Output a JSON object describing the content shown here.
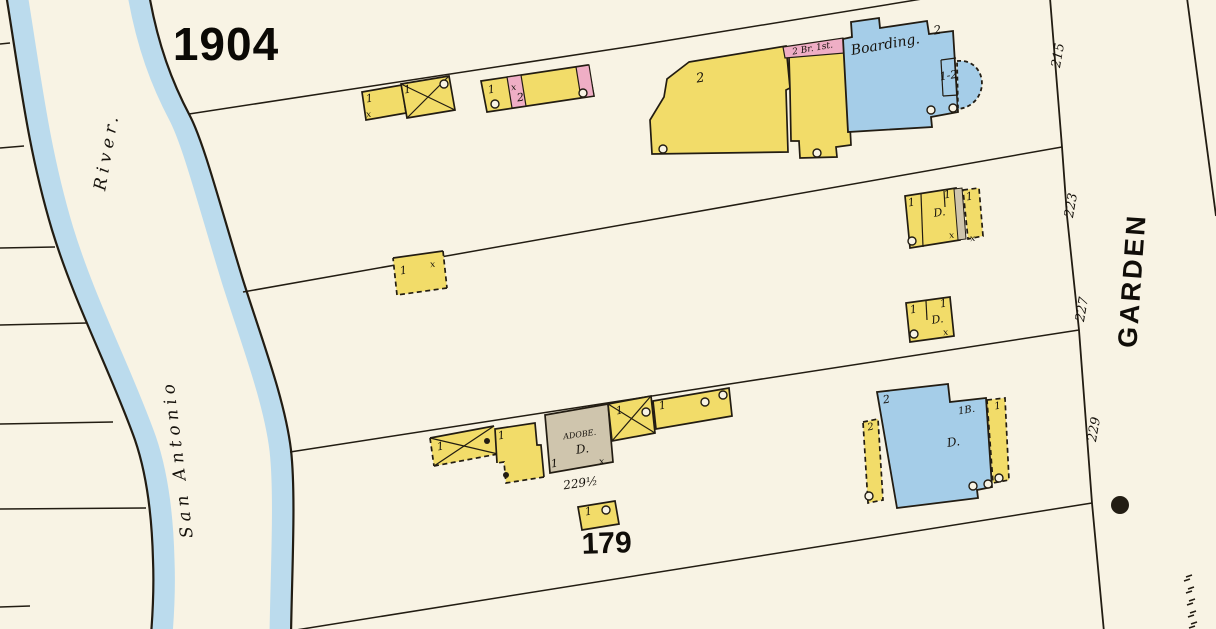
{
  "map": {
    "year": "1904",
    "block_number": "179",
    "street": {
      "name": "GARDEN",
      "house_numbers": [
        "215",
        "223",
        "227",
        "229"
      ]
    },
    "river": {
      "name": "San Antonio River."
    },
    "building_notes": [
      "Boarding.",
      "2 Br. 1st.",
      "ADOBE.",
      "D.",
      "229½",
      "1B.",
      "1-2"
    ],
    "colors": {
      "paper": "#f8f3e4",
      "ink": "#221c12",
      "water": "#b7d9ed",
      "yellow": "#f2dc69",
      "pink": "#efaec5",
      "blue": "#a5cde8",
      "adobe": "#cfc5ad"
    },
    "annotations": [
      {
        "id": "year",
        "t": "1904",
        "x": 226,
        "y": 60,
        "s": 46,
        "r": 0,
        "c": "t-year"
      },
      {
        "id": "river-name-river",
        "t": "River.",
        "x": 112,
        "y": 152,
        "s": 17,
        "r": -80,
        "c": "t-hand",
        "ls": 5
      },
      {
        "id": "river-name-san-antonio",
        "t": "San Antonio",
        "x": 183,
        "y": 458,
        "s": 17,
        "r": -97,
        "c": "t-hand",
        "ls": 5
      },
      {
        "id": "street-name-garden",
        "t": "GARDEN",
        "x": 1141,
        "y": 281,
        "s": 27,
        "r": -86,
        "c": "t-street",
        "ls": 3
      },
      {
        "id": "house-number-215",
        "t": "215",
        "x": 1062,
        "y": 56,
        "s": 13,
        "r": -80,
        "c": "t-hand"
      },
      {
        "id": "house-number-223",
        "t": "223",
        "x": 1075,
        "y": 206,
        "s": 13,
        "r": -80,
        "c": "t-hand"
      },
      {
        "id": "house-number-227",
        "t": "227",
        "x": 1086,
        "y": 310,
        "s": 13,
        "r": -80,
        "c": "t-hand"
      },
      {
        "id": "house-number-229",
        "t": "229",
        "x": 1098,
        "y": 430,
        "s": 13,
        "r": -80,
        "c": "t-hand"
      },
      {
        "id": "block-number",
        "t": "179",
        "x": 607,
        "y": 553,
        "s": 30,
        "r": -2,
        "c": "t-block"
      },
      {
        "id": "boarding-label",
        "t": "Boarding.",
        "x": 886,
        "y": 49,
        "s": 14,
        "r": -10,
        "c": "t-hand"
      },
      {
        "id": "brick-note",
        "t": "2 Br. 1st.",
        "x": 813,
        "y": 51,
        "s": 9,
        "r": -10,
        "c": "t-hand"
      },
      {
        "id": "complex-stories",
        "t": "2",
        "x": 701,
        "y": 82,
        "s": 13,
        "r": -9,
        "c": "t-hand"
      },
      {
        "id": "boarding-stories",
        "t": "2",
        "x": 938,
        "y": 34,
        "s": 12,
        "r": -9,
        "c": "t-hand"
      },
      {
        "id": "boarding-bay-stories",
        "t": "1-2",
        "x": 949,
        "y": 79,
        "s": 11,
        "r": -9,
        "c": "t-hand"
      },
      {
        "id": "b1-stories-a",
        "t": "1",
        "x": 370,
        "y": 102,
        "s": 11,
        "r": -9,
        "c": "t-hand"
      },
      {
        "id": "b1-stories-b",
        "t": "1",
        "x": 408,
        "y": 93,
        "s": 11,
        "r": -9,
        "c": "t-hand"
      },
      {
        "id": "b1-x",
        "t": "x",
        "x": 369,
        "y": 117,
        "s": 9,
        "r": -9,
        "c": "t-hand"
      },
      {
        "id": "b2-stories-a",
        "t": "1",
        "x": 492,
        "y": 93,
        "s": 11,
        "r": -9,
        "c": "t-hand"
      },
      {
        "id": "b2-stories-b",
        "t": "2",
        "x": 521,
        "y": 101,
        "s": 11,
        "r": -9,
        "c": "t-hand"
      },
      {
        "id": "b2-x",
        "t": "x",
        "x": 514,
        "y": 90,
        "s": 9,
        "r": -9,
        "c": "t-hand"
      },
      {
        "id": "b4-stories-a",
        "t": "1",
        "x": 912,
        "y": 206,
        "s": 11,
        "r": -9,
        "c": "t-hand"
      },
      {
        "id": "b4-stories-b",
        "t": "1",
        "x": 948,
        "y": 198,
        "s": 11,
        "r": -9,
        "c": "t-hand"
      },
      {
        "id": "b4-stories-c",
        "t": "1",
        "x": 970,
        "y": 200,
        "s": 11,
        "r": -9,
        "c": "t-hand"
      },
      {
        "id": "b4-dwelling",
        "t": "D.",
        "x": 940,
        "y": 216,
        "s": 11,
        "r": -9,
        "c": "t-hand"
      },
      {
        "id": "b4-x-a",
        "t": "x",
        "x": 952,
        "y": 238,
        "s": 9,
        "r": -9,
        "c": "t-hand"
      },
      {
        "id": "b4-x-b",
        "t": "x",
        "x": 973,
        "y": 241,
        "s": 9,
        "r": -9,
        "c": "t-hand"
      },
      {
        "id": "b5-stories-a",
        "t": "1",
        "x": 914,
        "y": 313,
        "s": 11,
        "r": -9,
        "c": "t-hand"
      },
      {
        "id": "b5-stories-b",
        "t": "1",
        "x": 944,
        "y": 307,
        "s": 11,
        "r": -9,
        "c": "t-hand"
      },
      {
        "id": "b5-dwelling",
        "t": "D.",
        "x": 938,
        "y": 323,
        "s": 11,
        "r": -9,
        "c": "t-hand"
      },
      {
        "id": "b5-x",
        "t": "x",
        "x": 946,
        "y": 335,
        "s": 9,
        "r": -9,
        "c": "t-hand"
      },
      {
        "id": "b6-stories",
        "t": "1",
        "x": 404,
        "y": 274,
        "s": 11,
        "r": -9,
        "c": "t-hand"
      },
      {
        "id": "b6-x",
        "t": "x",
        "x": 433,
        "y": 267,
        "s": 9,
        "r": -9,
        "c": "t-hand"
      },
      {
        "id": "b7-porch-stories",
        "t": "1",
        "x": 441,
        "y": 450,
        "s": 11,
        "r": -9,
        "c": "t-hand"
      },
      {
        "id": "b7-center-stories",
        "t": "1",
        "x": 502,
        "y": 439,
        "s": 11,
        "r": -9,
        "c": "t-hand"
      },
      {
        "id": "adobe-label",
        "t": "ADOBE.",
        "x": 580,
        "y": 437,
        "s": 8,
        "r": -8,
        "c": "t-hand"
      },
      {
        "id": "adobe-dwelling",
        "t": "D.",
        "x": 583,
        "y": 453,
        "s": 12,
        "r": -8,
        "c": "t-hand"
      },
      {
        "id": "adobe-stories",
        "t": "1",
        "x": 555,
        "y": 467,
        "s": 11,
        "r": -8,
        "c": "t-hand"
      },
      {
        "id": "adobe-x",
        "t": "x",
        "x": 602,
        "y": 464,
        "s": 9,
        "r": -8,
        "c": "t-hand"
      },
      {
        "id": "adobe-address",
        "t": "229½",
        "x": 581,
        "y": 487,
        "s": 12,
        "r": -8,
        "c": "t-hand"
      },
      {
        "id": "b7-xbldg-stories",
        "t": "1",
        "x": 620,
        "y": 414,
        "s": 11,
        "r": -9,
        "c": "t-hand"
      },
      {
        "id": "b7-bar-stories",
        "t": "1",
        "x": 663,
        "y": 409,
        "s": 11,
        "r": -9,
        "c": "t-hand"
      },
      {
        "id": "b8-stories",
        "t": "1",
        "x": 589,
        "y": 515,
        "s": 11,
        "r": -9,
        "c": "t-hand"
      },
      {
        "id": "b9-stories",
        "t": "2",
        "x": 887,
        "y": 403,
        "s": 11,
        "r": -9,
        "c": "t-hand"
      },
      {
        "id": "b9-basement",
        "t": "1B.",
        "x": 967,
        "y": 413,
        "s": 10,
        "r": -9,
        "c": "t-hand"
      },
      {
        "id": "b9-dwelling",
        "t": "D.",
        "x": 954,
        "y": 446,
        "s": 12,
        "r": -9,
        "c": "t-hand"
      },
      {
        "id": "b9-porch-left-stories",
        "t": "2",
        "x": 871,
        "y": 430,
        "s": 10,
        "r": -9,
        "c": "t-hand"
      },
      {
        "id": "b9-porch-right-stories",
        "t": "1",
        "x": 998,
        "y": 409,
        "s": 10,
        "r": -9,
        "c": "t-hand"
      }
    ]
  }
}
